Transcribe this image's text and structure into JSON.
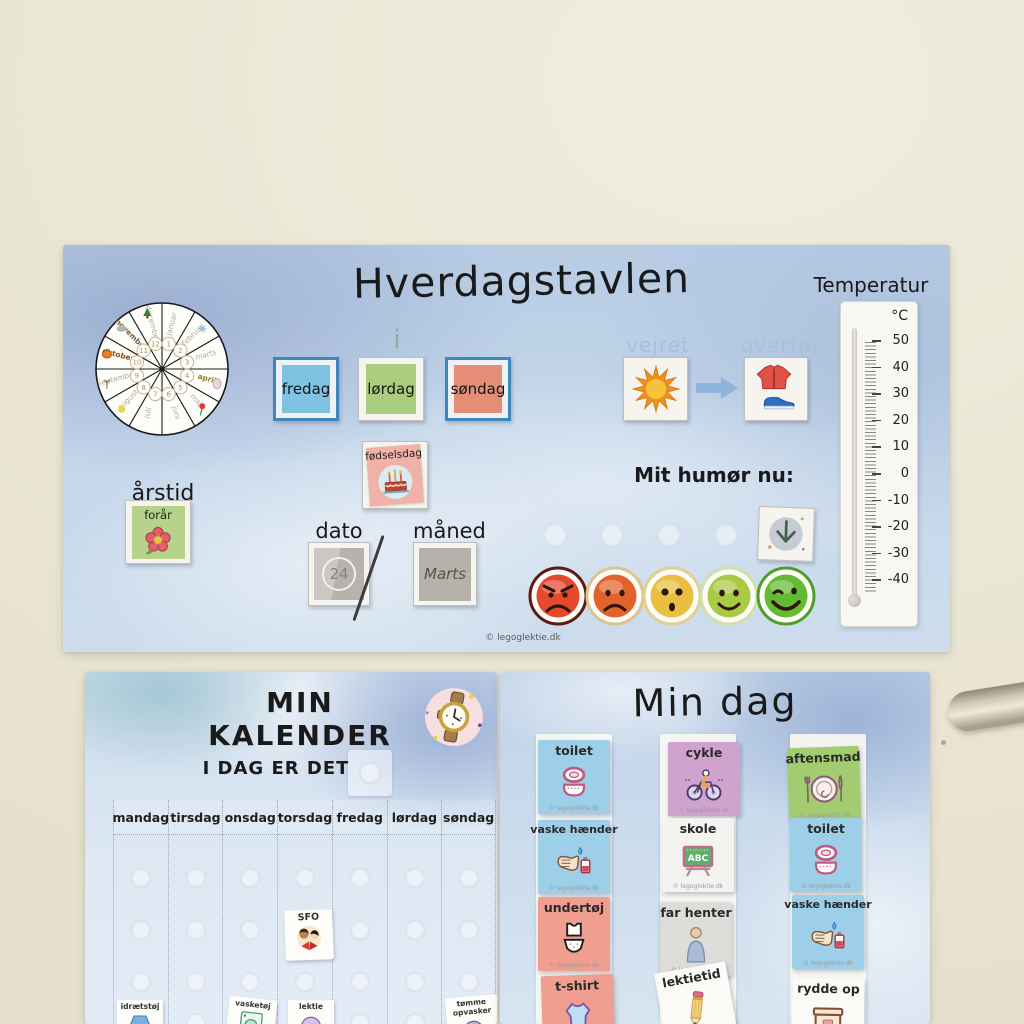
{
  "wall": {
    "object_right": "metal-door-handle"
  },
  "top_board": {
    "title": "Hverdagstavlen",
    "copyright": "© legoglektie.dk",
    "month_wheel": {
      "months": [
        "januar",
        "februar",
        "marts",
        "april",
        "maj",
        "juni",
        "juli",
        "august",
        "september",
        "oktober",
        "november",
        "december"
      ],
      "numbers": [
        "1",
        "2",
        "3",
        "4",
        "5",
        "6",
        "7",
        "8",
        "9",
        "10",
        "11",
        "12"
      ],
      "icons": {
        "februar": "snowflake-icon",
        "april": "easter-egg-icon",
        "maj": "tulip-icon",
        "august": "sun-dot-icon",
        "september": "bare-tree-icon",
        "oktober": "pumpkin-icon",
        "november": "cloud-icon",
        "december": "christmas-tree-icon"
      }
    },
    "today": {
      "label": "i dag",
      "days": [
        {
          "label": "fredag",
          "color": "#7fc3e2",
          "frame": "blue"
        },
        {
          "label": "lørdag",
          "color": "#a9cd7c",
          "frame": "white"
        },
        {
          "label": "søndag",
          "color": "#e68d77",
          "frame": "blue"
        }
      ]
    },
    "birthday_card": {
      "label": "fødselsdag",
      "icon": "birthday-cake-icon",
      "color": "#f0b2a7"
    },
    "season": {
      "label": "årstid",
      "value": "forår",
      "icon": "flower-icon",
      "color": "#b5d48a"
    },
    "date": {
      "label": "dato",
      "value": "24"
    },
    "month": {
      "label": "måned",
      "value": "Marts"
    },
    "weather": {
      "label": "vejret",
      "icon": "sun-icon"
    },
    "outerwear": {
      "label": "overtøj",
      "icons": [
        "jacket-icon",
        "sneaker-icon"
      ]
    },
    "mood": {
      "label": "Mit humør nu:",
      "selector_icon": "down-arrow-icon",
      "faces": [
        {
          "name": "angry",
          "color": "#e4492e",
          "ring": "#5c1a12"
        },
        {
          "name": "sad",
          "color": "#e2622e",
          "ring": "#dcc48e"
        },
        {
          "name": "surprised",
          "color": "#e9bf41",
          "ring": "#e3cf92"
        },
        {
          "name": "happy",
          "color": "#a9ca44",
          "ring": "#cfe0a8"
        },
        {
          "name": "wink",
          "color": "#63bb33",
          "ring": "#4f9e2d"
        }
      ]
    },
    "thermometer": {
      "title": "Temperatur",
      "unit": "°C",
      "ticks": [
        "50",
        "40",
        "30",
        "20",
        "10",
        "0",
        "-10",
        "-20",
        "-30",
        "-40"
      ]
    }
  },
  "calendar_board": {
    "title": "MIN KALENDER",
    "subtitle": "I DAG ER DET",
    "icon": "wristwatch-icon",
    "weekdays": [
      "mandag",
      "tirsdag",
      "onsdag",
      "torsdag",
      "fredag",
      "lørdag",
      "søndag"
    ],
    "placed_cards": [
      {
        "label": "SFO",
        "icon": "children-reading-icon",
        "column": "torsdag"
      }
    ],
    "bottom_cards": [
      {
        "label": "idrætstøj",
        "icon": "sports-clothes-icon",
        "column": "mandag"
      },
      {
        "label": "vasketøj",
        "icon": "laundry-icon",
        "column": "onsdag"
      },
      {
        "label": "lektie",
        "icon": "homework-icon",
        "column": "torsdag"
      },
      {
        "label": "tømme opvasker",
        "icon": "dishwasher-icon",
        "column": "søndag"
      }
    ]
  },
  "day_board": {
    "title": "Min dag",
    "card_watermark": "© legoglektie.dk",
    "columns": [
      {
        "cards": [
          {
            "label": "toilet",
            "icon": "toilet-icon",
            "color": "#9ecfe9"
          },
          {
            "label": "vaske hænder",
            "icon": "wash-hands-icon",
            "color": "#9ecfe9"
          },
          {
            "label": "undertøj",
            "icon": "underwear-icon",
            "color": "#ef9e90"
          },
          {
            "label": "t-shirt",
            "icon": "tshirt-icon",
            "color": "#ef9e90"
          }
        ]
      },
      {
        "cards": [
          {
            "label": "cykle",
            "icon": "bicycle-icon",
            "color": "#d0a3cf"
          },
          {
            "label": "skole",
            "icon": "school-board-icon",
            "color": "#f5f3ef",
            "icon_text": "ABC"
          },
          {
            "label": "far henter",
            "icon": "person-icon",
            "color": "#dddcd8"
          },
          {
            "label": "lektietid",
            "icon": "pencil-icon",
            "color": "#fbfaf6"
          }
        ]
      },
      {
        "cards": [
          {
            "label": "aftensmad",
            "icon": "dinner-plate-icon",
            "color": "#a3cc70"
          },
          {
            "label": "toilet",
            "icon": "toilet-icon",
            "color": "#9ecfe9"
          },
          {
            "label": "vaske hænder",
            "icon": "wash-hands-icon",
            "color": "#9ecfe9"
          },
          {
            "label": "rydde op",
            "icon": "tidy-up-box-icon",
            "color": "#fbfaf6"
          }
        ]
      }
    ]
  }
}
